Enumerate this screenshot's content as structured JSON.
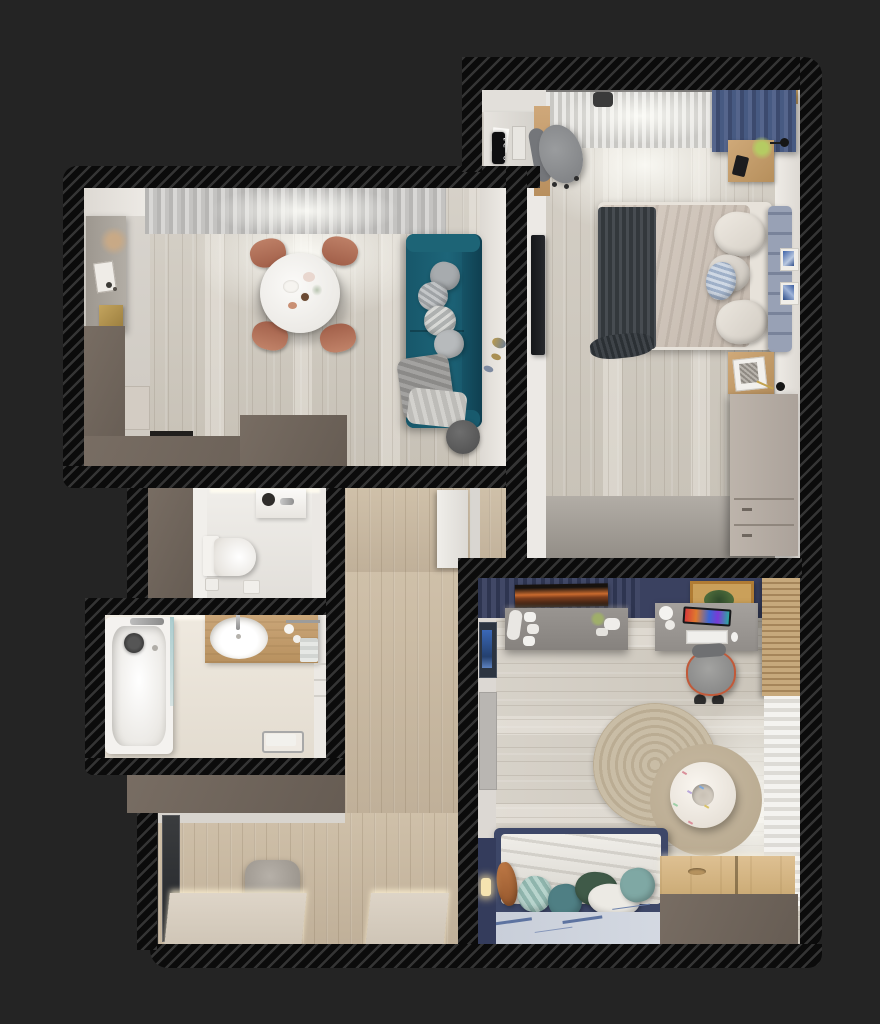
{
  "scene": {
    "type": "apartment-floor-plan-3d-top-view",
    "background": "#242424",
    "wall_style": "black diagonal hatch exterior walls, taupe partition tops",
    "clock_time": "8:31"
  },
  "palette": {
    "background": "#242424",
    "wall_hatch_dark": "#0b0b0b",
    "wall_hatch_light": "#343434",
    "partition_taupe": "#6f655c",
    "wood_floor_light": "#d0cabf",
    "wood_floor_warm": "#c9b9a2",
    "teal_sofa": "#1b5d70",
    "copper_chair": "#b3735c",
    "navy_drapes": "#4a5a80",
    "navy_accent_wall": "#3a4160",
    "kids_bed_navy": "#3d4768",
    "headboard_blue_grey": "#8e97ab",
    "round_rug_beige": "#c6baa3",
    "vanity_wood": "#c49f72",
    "bench_wood": "#d9b886"
  },
  "rooms": {
    "living_dining": {
      "name": "living-dining room with kitchen",
      "items": [
        "kitchen counter with dried pampas, frame and gold box",
        "tall kitchen cabinet",
        "round white dining table with breakfast set",
        "four copper dining chairs",
        "teal two-seat sofa with grey pillows and throws",
        "round dark side table",
        "grey sheer window curtains",
        "gold fish wall decor"
      ]
    },
    "bedroom": {
      "name": "bedroom",
      "clock_time": "8:31",
      "items": [
        "double bed with beige duvet and dark grey throw",
        "blue-grey channel headboard",
        "two wooden nightstands with black wall lamps",
        "phone and green plant on nightstand",
        "work desk with grey office chair",
        "digital wall clock",
        "wall mounted TV",
        "taupe dresser",
        "white sheer curtain and navy drapes",
        "two blue art prints"
      ]
    },
    "wc": {
      "name": "toilet room",
      "items": [
        "wall-hung toilet",
        "corner washbasin with faucet",
        "toilet paper holder",
        "flush bin"
      ]
    },
    "bathroom": {
      "name": "bathroom",
      "items": [
        "bathtub with glass screen",
        "dark shower head",
        "colorful mosaic tile strip",
        "wooden vanity with oval white basin",
        "chrome faucet",
        "toiletry bottles and towels",
        "chrome floor towel rack"
      ]
    },
    "hallway": {
      "name": "hallway",
      "items": [
        "grey pouf",
        "tall dark floor mirror",
        "two low lit cabinets",
        "white interior door"
      ]
    },
    "kids_room": {
      "name": "kids room",
      "items": [
        "navy slatted accent wall",
        "sunset poster",
        "orange framed picture",
        "grey wall shelf with sneakers, gamepads and gadgets",
        "desk with colorful monitor, keyboard and white lamp",
        "grey office chair with orange trim",
        "round jute rug",
        "donut-shaped sprinkle pouf",
        "navy bed with white duvet and teal-green pillows",
        "blue map-pattern rug",
        "wooden window bench with pull hole",
        "wooden blinds and sheer curtain"
      ]
    }
  }
}
